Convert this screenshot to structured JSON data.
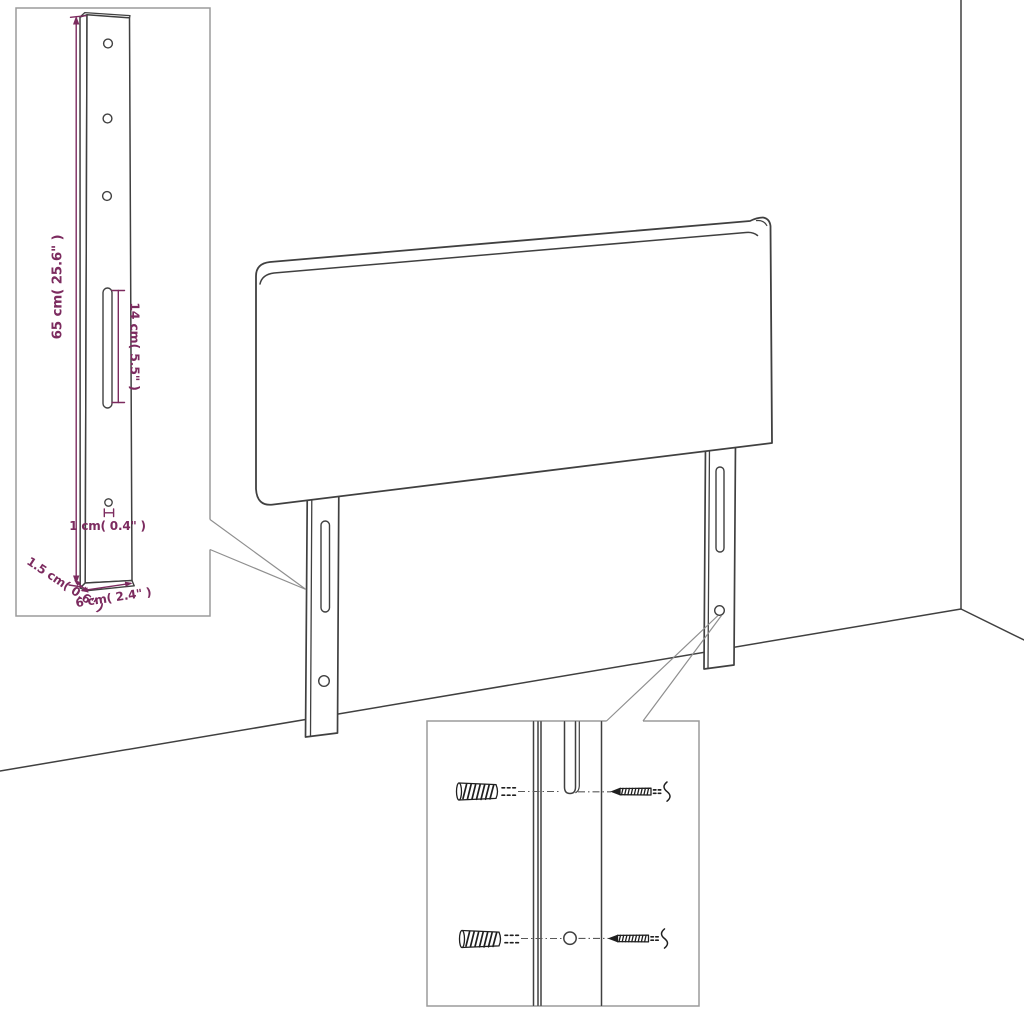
{
  "colors": {
    "background": "#ffffff",
    "outline": "#404040",
    "dimension": "#7c2b5f",
    "inset_border": "#9b9b9b",
    "callout": "#8f8f8f",
    "hardware": "#1f1f1f"
  },
  "leg_detail_inset": {
    "dim_total_height": "65 cm( 25.6\" )",
    "dim_slot_length": "14 cm( 5.5\" )",
    "dim_hole_diameter": "1 cm( 0.4\" )",
    "dim_thickness": "1.5 cm( 0.6\" )",
    "dim_width": "6 cm( 2.4\" )"
  }
}
